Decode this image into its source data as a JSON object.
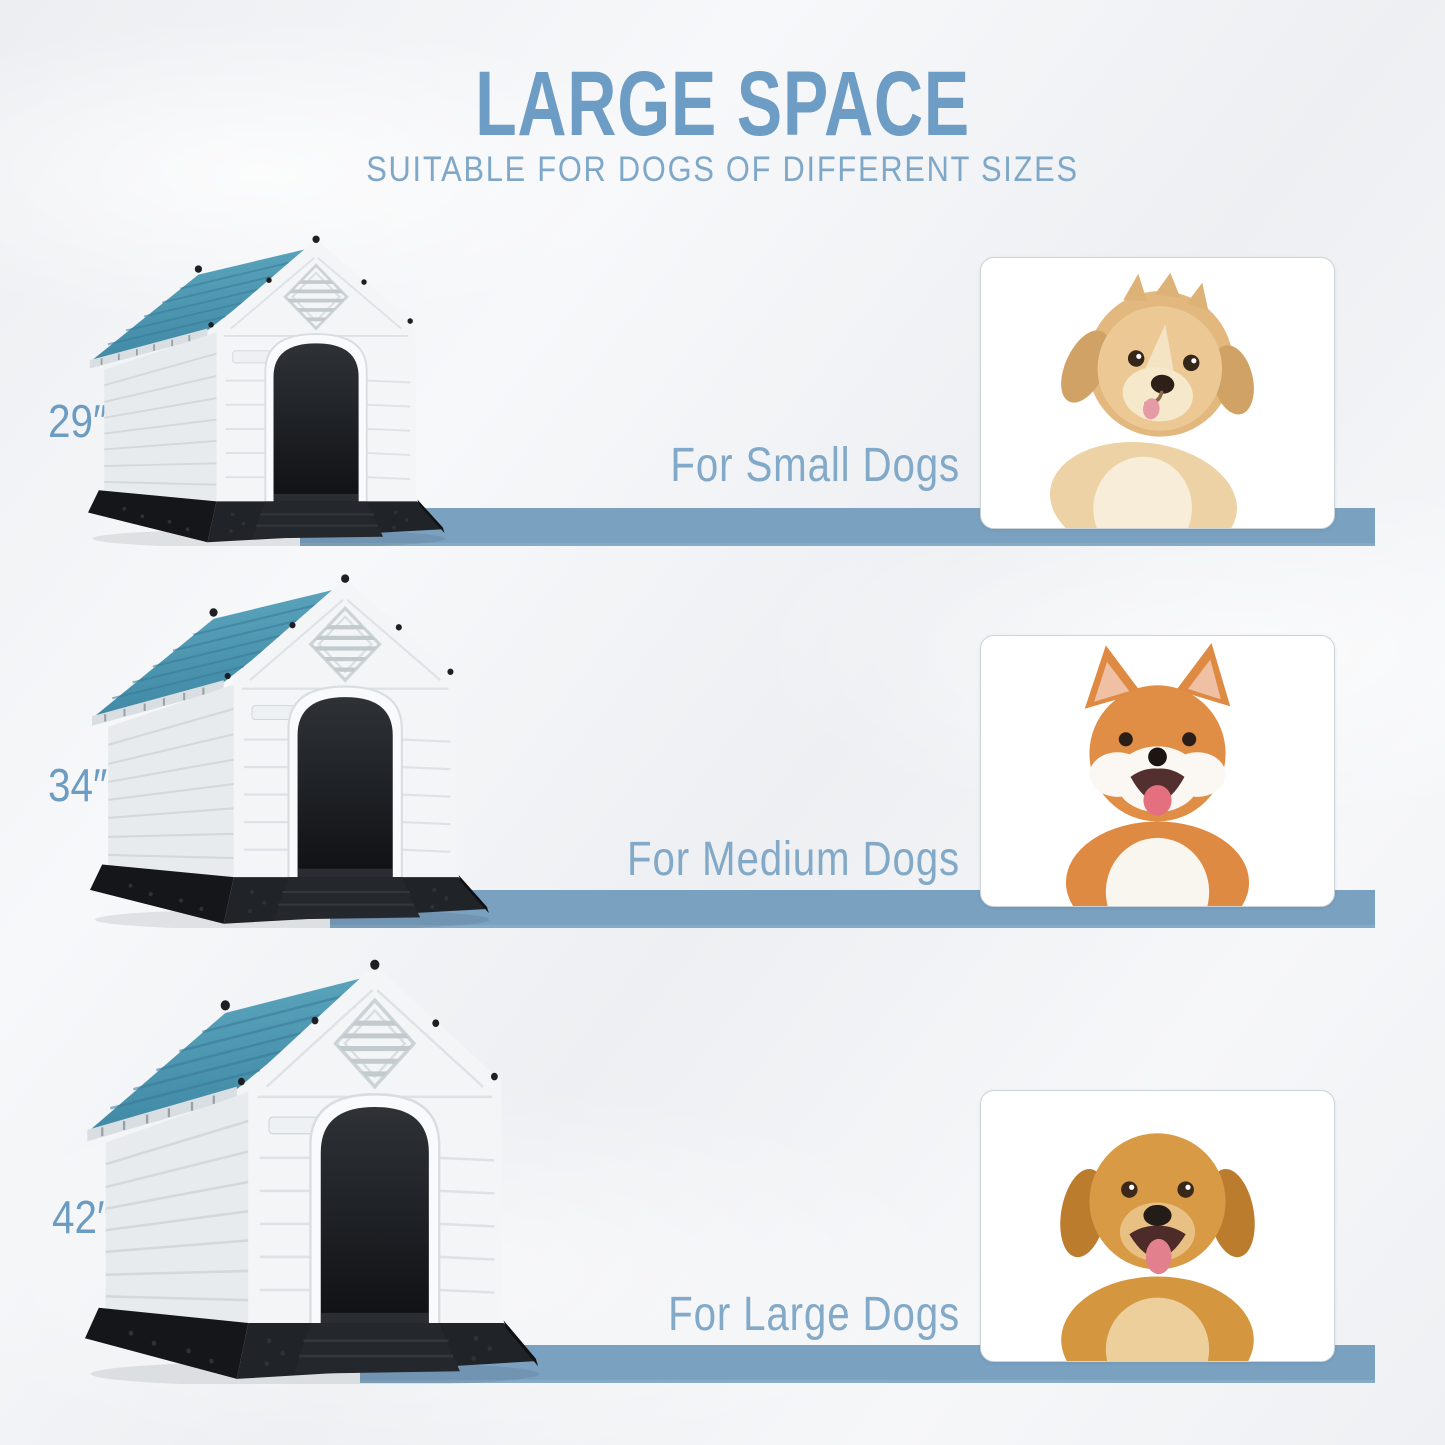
{
  "header": {
    "title": "LARGE SPACE",
    "subtitle": "SUITABLE FOR DOGS OF DIFFERENT SIZES"
  },
  "rows": [
    {
      "size_label": "29″",
      "audience_label": "For Small Dogs",
      "dog_photo": "small-fluffy-puppy-photo"
    },
    {
      "size_label": "34″",
      "audience_label": "For Medium Dogs",
      "dog_photo": "shiba-inu-photo"
    },
    {
      "size_label": "42″",
      "audience_label": "For Large Dogs",
      "dog_photo": "golden-retriever-photo"
    }
  ],
  "illustration": "plastic-dog-house-with-teal-roof",
  "colors": {
    "title_blue": "#6d9cc4",
    "label_blue": "#82a9c7",
    "bar_blue": "#7aa1c0",
    "roof_teal": "#4a92ad",
    "house_body": "#eef1f3",
    "base_black": "#1a1c1f",
    "background": "#f2f4f6"
  }
}
